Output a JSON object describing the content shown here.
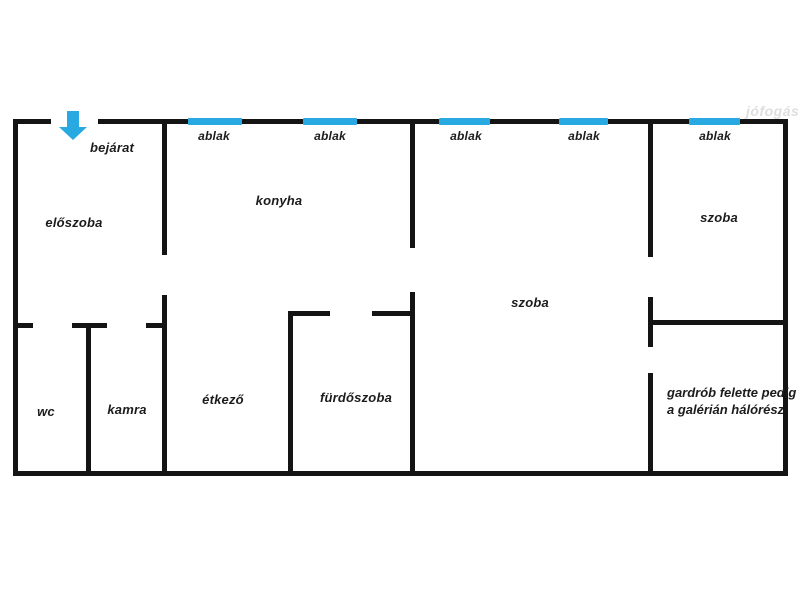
{
  "watermark": "jófogás",
  "colors": {
    "wall": "#141414",
    "window": "#29a9e1",
    "arrow": "#29a9e1"
  },
  "entrance": {
    "label": "bejárat"
  },
  "windows": [
    {
      "label": "ablak"
    },
    {
      "label": "ablak"
    },
    {
      "label": "ablak"
    },
    {
      "label": "ablak"
    },
    {
      "label": "ablak"
    }
  ],
  "rooms": {
    "eloszoba": "előszoba",
    "konyha": "konyha",
    "szoba_center": "szoba",
    "szoba_right": "szoba",
    "wc": "wc",
    "kamra": "kamra",
    "etkezo": "étkező",
    "furdoszoba": "fürdőszoba"
  },
  "annotation": {
    "line1": "gardrób felette pedig",
    "line2": "a galérián hálórész"
  }
}
